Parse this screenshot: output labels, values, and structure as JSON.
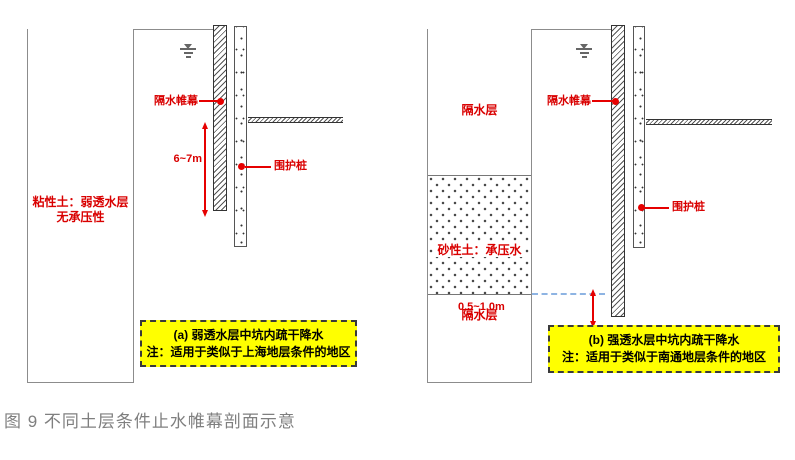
{
  "figure_caption": "图 9 不同土层条件止水帷幕剖面示意",
  "colors": {
    "label_red": "#d90000",
    "arrow_red": "#e60000",
    "highlight_yellow": "#ffff00",
    "caption_gray": "#7f7f7f",
    "water_dash_blue": "#8eb4e3",
    "line_gray": "#8c8c8c"
  },
  "icons": {
    "water_table": "water-table-symbol"
  },
  "diagram_a": {
    "soil_label": {
      "line1": "粘性土：弱透水层",
      "line2": "无承压性"
    },
    "curtain_label": "隔水帷幕",
    "pile_label": "围护桩",
    "depth_dimension": "6~7m",
    "panel_title": "(a) 弱透水层中坑内疏干降水",
    "panel_note": "注：适用于类似于上海地层条件的地区"
  },
  "diagram_b": {
    "upper_aquitard_label": "隔水层",
    "sand_label": "砂性土：承压水",
    "lower_aquitard_label": "隔水层",
    "curtain_label": "隔水帷幕",
    "pile_label": "围护桩",
    "embed_dimension": "0.5~1.0m",
    "panel_title": "(b) 强透水层中坑内疏干降水",
    "panel_note": "注：适用于类似于南通地层条件的地区"
  }
}
